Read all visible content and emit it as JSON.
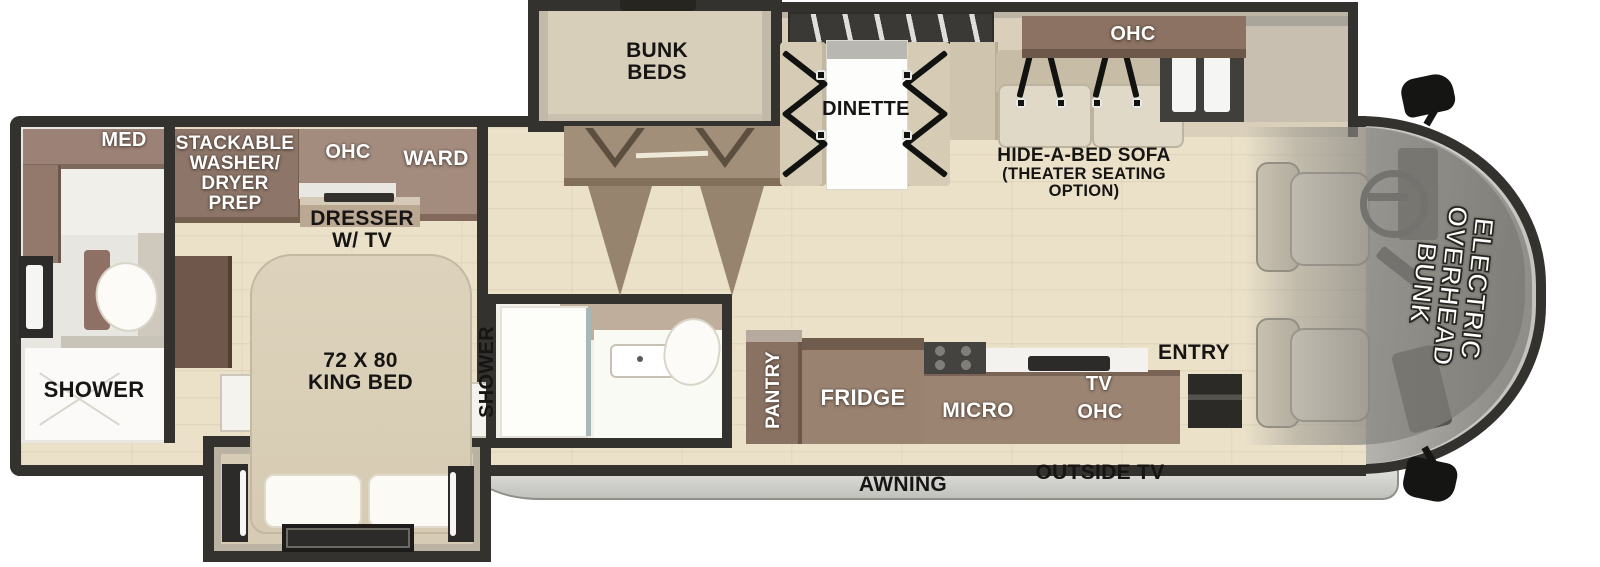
{
  "colors": {
    "wall": "#34322f",
    "floor_wood": "#ebe1c9",
    "slide_floor": "#d8cfba",
    "cabinet_mauve": "#a38b7e",
    "cabinet_brown": "#8a7263",
    "counter_brown": "#9c8473",
    "bed_beige": "#d9cfb8",
    "awning_gray": "#d6d6d3",
    "front_cap_gray": "#a8a6a0",
    "label_white": "#ffffff",
    "label_black": "#161514"
  },
  "rooms": {
    "rear_bath": {
      "med": "MED",
      "shower": "SHOWER"
    },
    "bedroom": {
      "washer_prep": "STACKABLE\nWASHER/\nDRYER\nPREP",
      "ohc": "OHC",
      "ward": "WARD",
      "dresser": "DRESSER\nW/ TV",
      "king_bed": "72 X 80\nKING BED"
    },
    "mid_bath": {
      "shower": "SHOWER"
    },
    "bunk_room": {
      "bunk_beds": "BUNK\nBEDS"
    },
    "living": {
      "dinette": "DINETTE",
      "sofa_title": "HIDE-A-BED SOFA",
      "sofa_sub": "(THEATER SEATING\nOPTION)",
      "sofa_ohc": "OHC"
    },
    "kitchen": {
      "pantry": "PANTRY",
      "fridge": "FRIDGE",
      "micro": "MICRO",
      "tv": "TV",
      "ohc": "OHC",
      "entry": "ENTRY"
    },
    "cab": {
      "overhead_bunk": "ELECTRIC\nOVERHEAD\nBUNK"
    },
    "exterior": {
      "awning": "AWNING",
      "outside_tv": "OUTSIDE TV"
    }
  }
}
